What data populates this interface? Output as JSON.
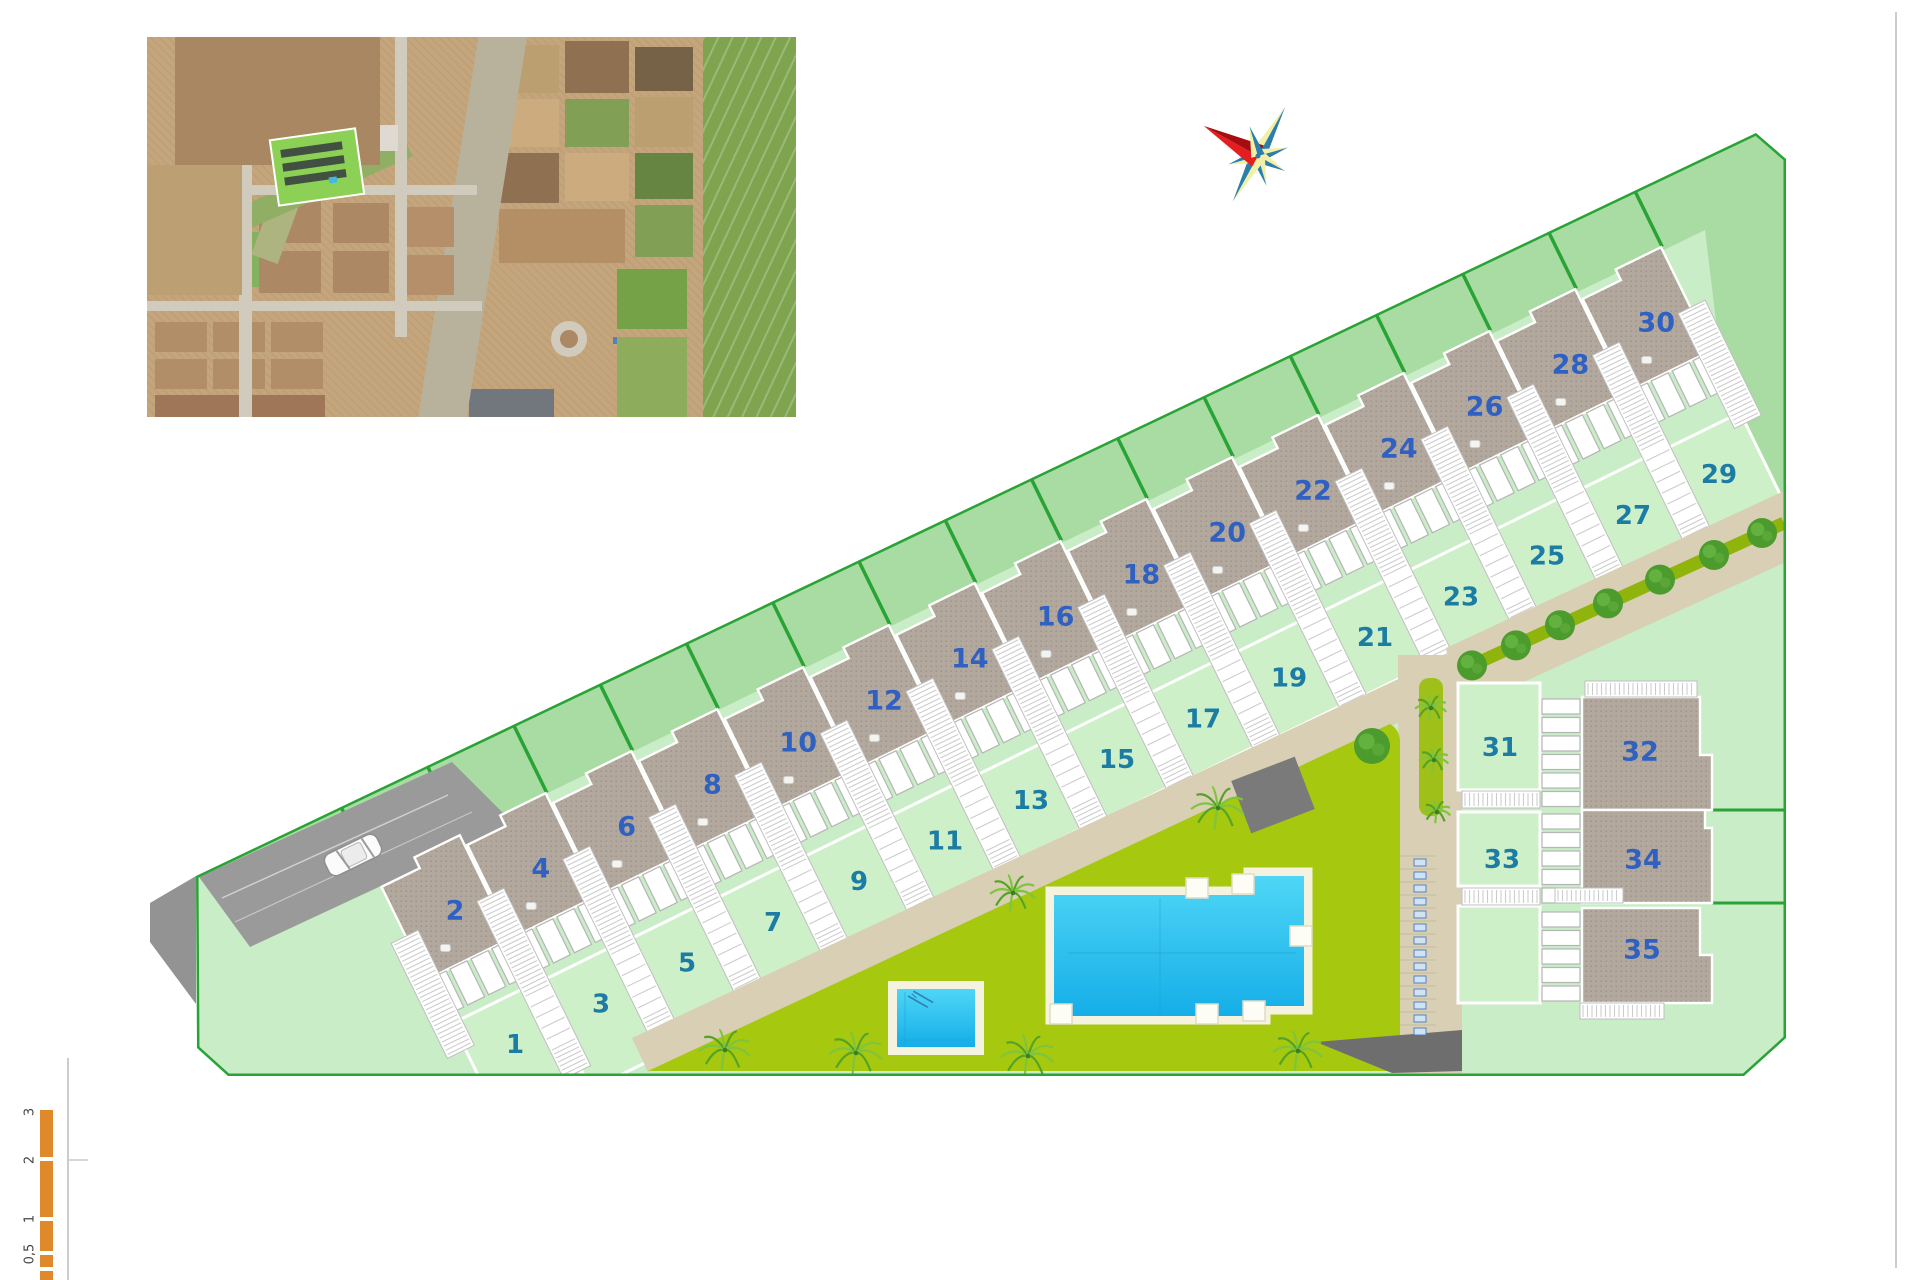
{
  "plan": {
    "row_roof_numbers": [
      "2",
      "4",
      "6",
      "8",
      "10",
      "12",
      "14",
      "16",
      "18",
      "20",
      "22",
      "24",
      "26",
      "28",
      "30"
    ],
    "row_garden_numbers": [
      "1",
      "3",
      "5",
      "7",
      "9",
      "11",
      "13",
      "15",
      "17",
      "19",
      "21",
      "23",
      "25",
      "27",
      "29"
    ],
    "cluster_roof_numbers": [
      "32",
      "34",
      "35"
    ],
    "cluster_garden_numbers": [
      "31",
      "33"
    ],
    "colors": {
      "boundary_green": "#2aa336",
      "backyard_green": "#a8dca2",
      "lawn_light_green": "#c9edc6",
      "garden_green": "#cdf0c8",
      "roof_gray": "#b2a89d",
      "roof_dot": "#9a9186",
      "path_beige": "#d8cfb4",
      "pool_lawn_olive": "#a6c80f",
      "hedge_olive": "#8fb50d",
      "water_blue": "#2ec3ee",
      "deck_cream": "#f5f2df",
      "roof_number_blue": "#3060c0",
      "garden_number_teal": "#1d7ca4",
      "driveway_gray": "#9a9a9a",
      "scale_orange": "#e0892b",
      "compass_red": "#e41d20",
      "compass_teal": "#2b7fad",
      "compass_yellow": "#f2efa7"
    }
  },
  "scale_bar": {
    "labels": [
      "3",
      "2",
      "1",
      "0,5"
    ]
  },
  "icons": {
    "compass": "compass-rose-icon",
    "car": "car-top-view-icon",
    "palm": "palm-tree-icon",
    "tree": "round-tree-icon",
    "pool": "swimming-pool",
    "slide": "pool-slide-icon"
  }
}
